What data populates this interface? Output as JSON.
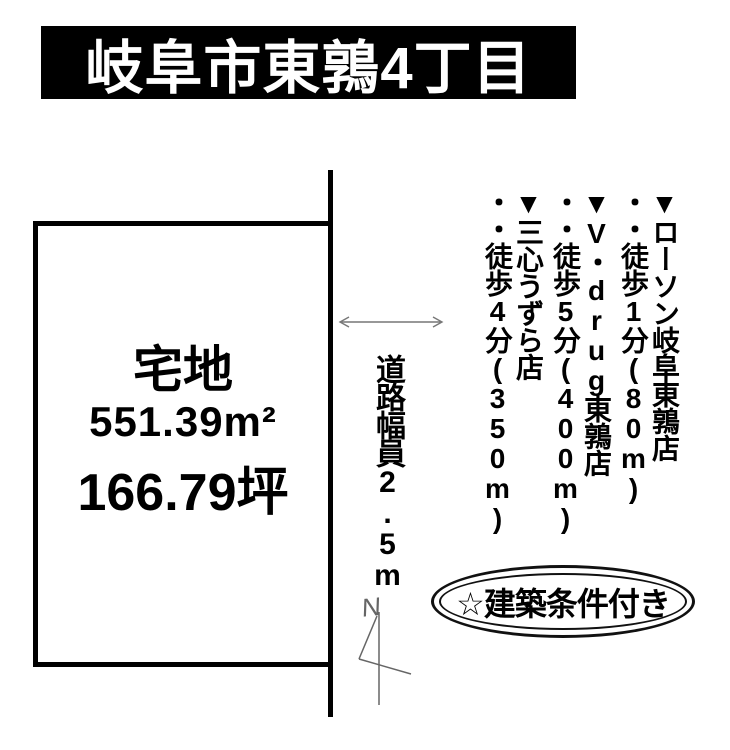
{
  "title": "岐阜市東鶉4丁目",
  "plot": {
    "land_type": "宅地",
    "area_sqm": "551.39m²",
    "area_tsubo": "166.79坪"
  },
  "road": {
    "width_label": "道路幅員2.5m"
  },
  "compass": {
    "label": "N"
  },
  "facilities": [
    {
      "marker": "▼",
      "name": "ローソン岐阜東鶉店",
      "leader": "・・",
      "walk": "徒歩1分(80m)"
    },
    {
      "marker": "▼",
      "name": "V・drug東鶉店",
      "leader": "・・",
      "walk": "徒歩5分(400m)"
    },
    {
      "marker": "▼",
      "name": "三心うずら店",
      "leader": "・・",
      "walk": "徒歩4分(350m)"
    }
  ],
  "badge": {
    "label": "☆建築条件付き"
  },
  "colors": {
    "ink": "#000000",
    "background": "#ffffff",
    "title_bg": "#000000",
    "title_text": "#ffffff",
    "thin_line": "#777777"
  }
}
